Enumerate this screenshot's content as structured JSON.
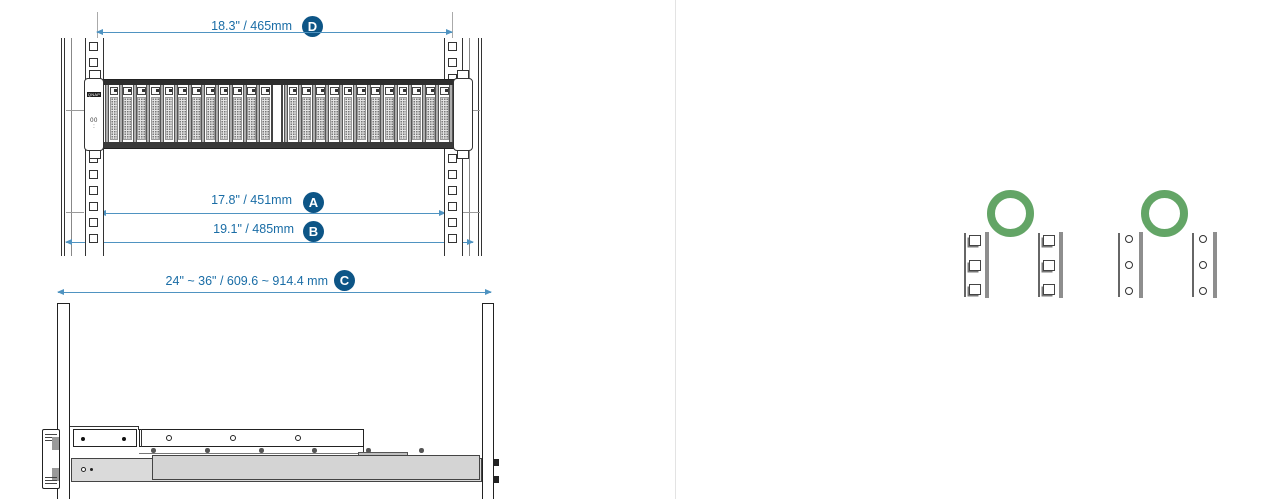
{
  "front_view": {
    "dimensions": {
      "d": {
        "id": "D",
        "label": "18.3\" / 465mm"
      },
      "a": {
        "id": "A",
        "label": "17.8\" / 451mm"
      },
      "b": {
        "id": "B",
        "label": "19.1\" / 485mm"
      }
    },
    "server": {
      "brand": "QNAP",
      "front_led_label": "00",
      "front_dot_label": ":",
      "drive_bay_count": 24,
      "bay_groups": 2
    },
    "rack_posts": {
      "count": 2,
      "hole_shape": "square",
      "visible_holes_per_post": 13
    }
  },
  "side_view": {
    "dimensions": {
      "c": {
        "id": "C",
        "label": "24\" ~ 36\" / 609.6 ~ 914.4 mm"
      }
    }
  },
  "rack_compatibility": {
    "square_hole": {
      "label": "square-hole rack posts",
      "hole_shape": "square",
      "posts": 2,
      "holes_per_post": 3,
      "status_icon": "ok-ring"
    },
    "round_hole": {
      "label": "round-hole rack posts",
      "hole_shape": "round",
      "posts": 2,
      "holes_per_post": 3,
      "status_icon": "ok-ring"
    }
  },
  "colors": {
    "dimension_text": "#1a6da6",
    "dimension_line": "#4f93c1",
    "badge_fill": "#0d5586",
    "ok_ring_green": "#63a566",
    "guide_line": "#aaaaaa"
  }
}
